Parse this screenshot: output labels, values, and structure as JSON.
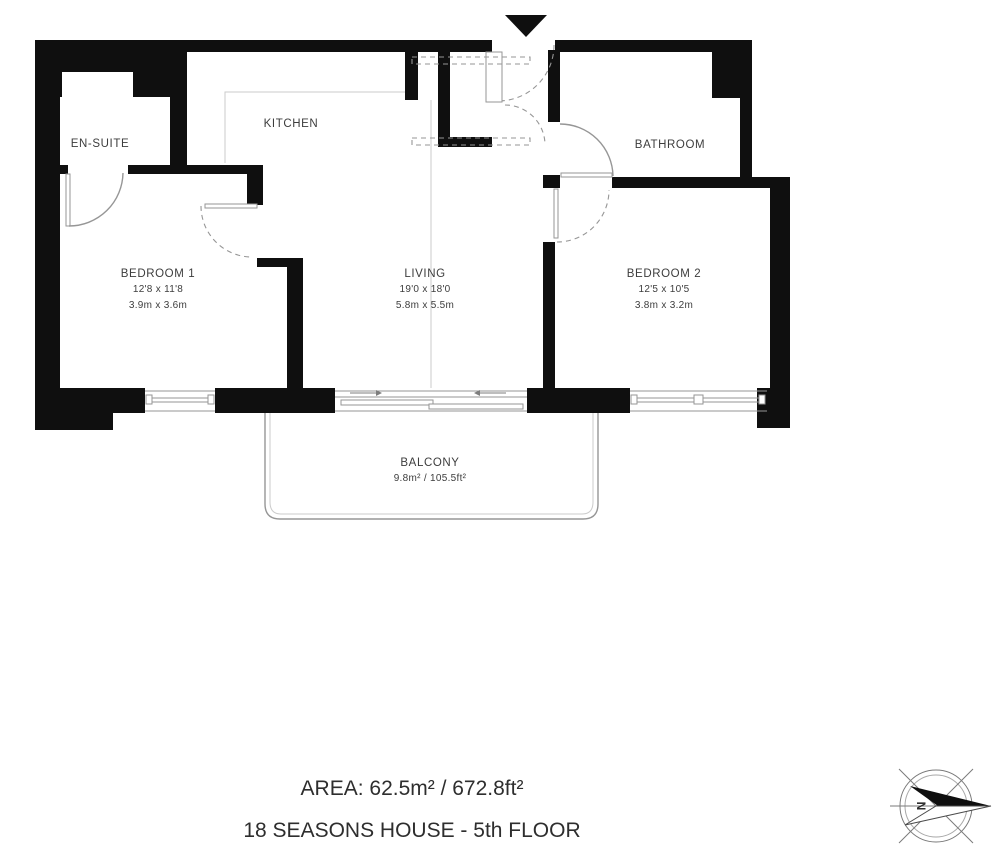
{
  "colors": {
    "wall": "#0f0f0f",
    "line": "#969696",
    "light_line": "#cbcbcb",
    "text": "#3d3d3d"
  },
  "rooms": {
    "ensuite": {
      "name": "EN-SUITE"
    },
    "kitchen": {
      "name": "KITCHEN"
    },
    "bathroom": {
      "name": "BATHROOM"
    },
    "bedroom1": {
      "name": "BEDROOM 1",
      "size_imperial": "12'8 x 11'8",
      "size_metric": "3.9m x 3.6m"
    },
    "living": {
      "name": "LIVING",
      "size_imperial": "19'0 x 18'0",
      "size_metric": "5.8m x 5.5m"
    },
    "bedroom2": {
      "name": "BEDROOM 2",
      "size_imperial": "12'5 x 10'5",
      "size_metric": "3.8m x 3.2m"
    },
    "balcony": {
      "name": "BALCONY",
      "area": "9.8m² / 105.5ft²"
    }
  },
  "footer": {
    "area_line": "AREA: 62.5m² / 672.8ft²",
    "building_line": "18 SEASONS HOUSE - 5th FLOOR"
  },
  "compass": {
    "north_label": "N"
  }
}
